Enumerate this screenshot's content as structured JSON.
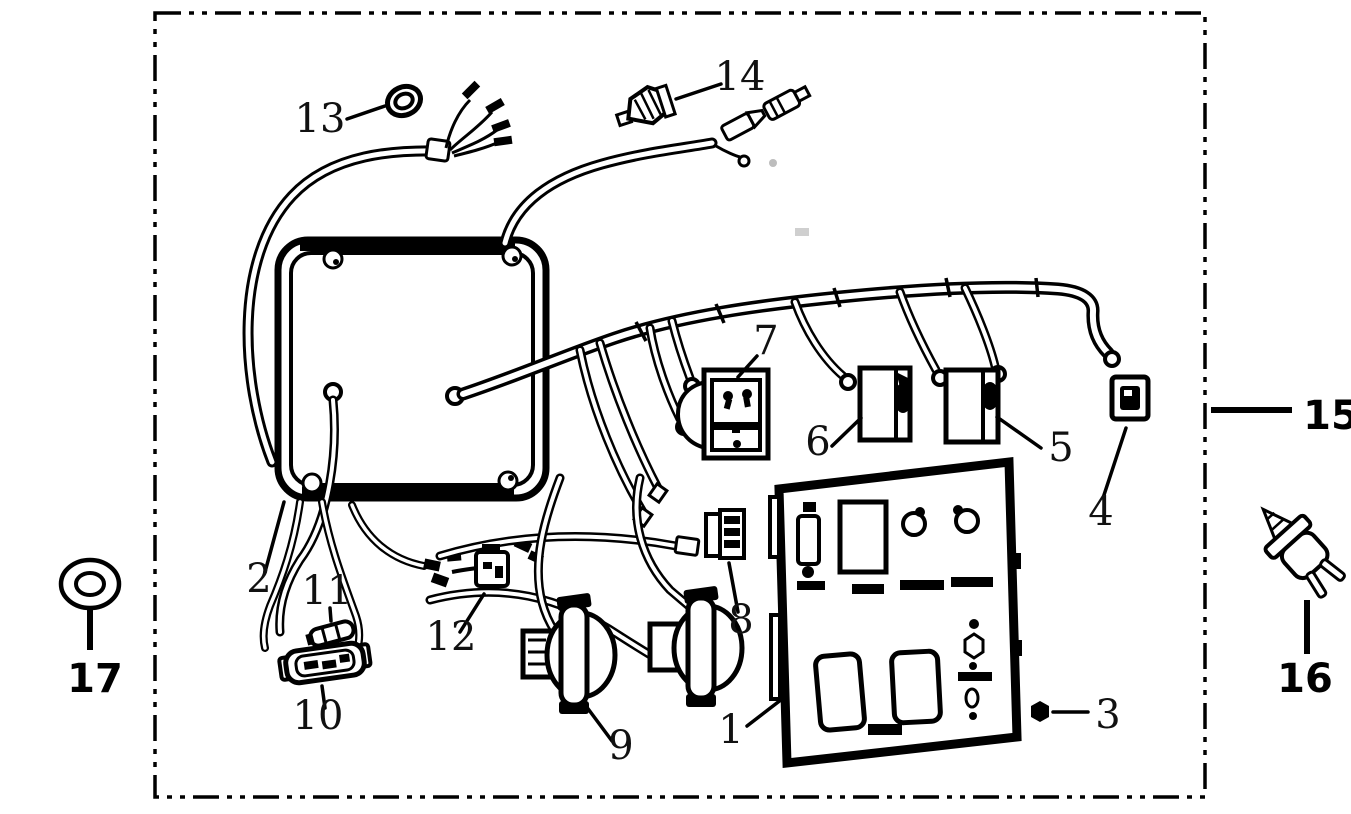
{
  "diagram": {
    "background": "#ffffff",
    "line_color": "#000000",
    "border_style": "dash-dot",
    "callouts": {
      "c1": "1",
      "c2": "2",
      "c3": "3",
      "c4": "4",
      "c5": "5",
      "c6": "6",
      "c7": "7",
      "c8": "8",
      "c9": "9",
      "c10": "10",
      "c11": "11",
      "c12": "12",
      "c13": "13",
      "c14": "14",
      "c15": "15",
      "c16": "16",
      "c17": "17"
    }
  }
}
